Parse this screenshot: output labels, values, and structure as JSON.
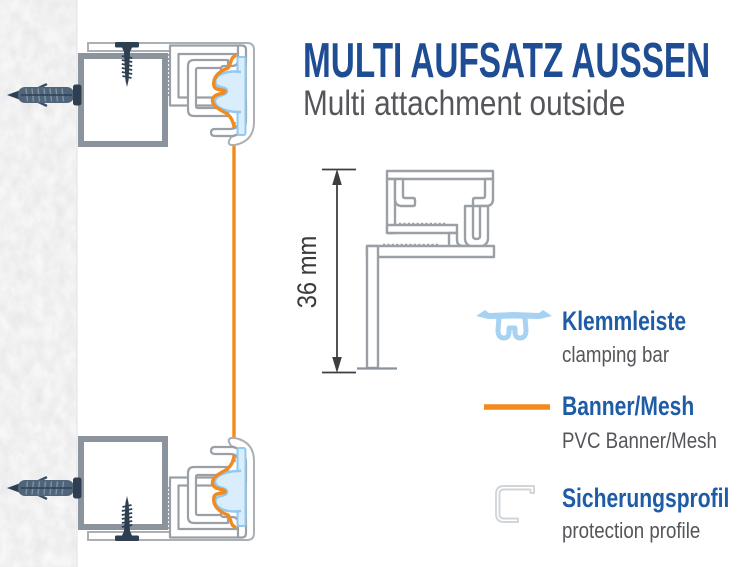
{
  "title": "MULTI AUFSATZ AUSSEN",
  "subtitle": "Multi attachment outside",
  "diagram": {
    "dimension_label": "36 mm"
  },
  "legend": {
    "items": [
      {
        "label": "Klemmleiste",
        "sublabel": "clamping bar",
        "icon": "clamping-bar-icon"
      },
      {
        "label": "Banner/Mesh",
        "sublabel": "PVC Banner/Mesh",
        "icon": "banner-line-icon"
      },
      {
        "label": "Sicherungsprofil",
        "sublabel": "protection profile",
        "icon": "protection-profile-icon"
      }
    ]
  },
  "colors": {
    "title_blue": "#1e4d94",
    "legend_blue": "#1f5ca6",
    "text_gray": "#54565a",
    "banner_orange": "#f28a1e",
    "clamp_blue": "#a8d2f2",
    "profile_gray": "#9aa0a6",
    "bracket_gray": "#8b949c",
    "screw_navy": "#2e3f52"
  }
}
